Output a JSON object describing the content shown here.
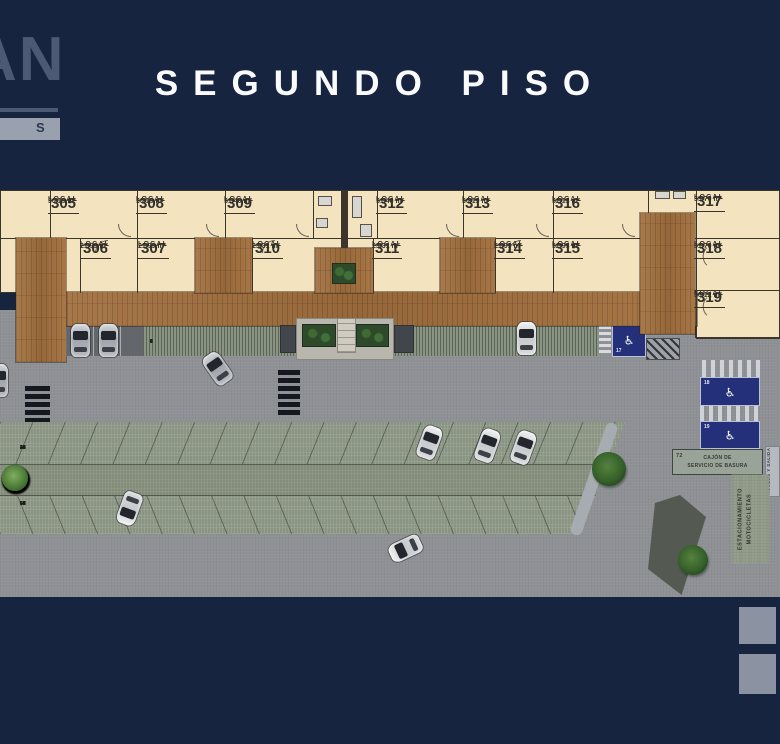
{
  "header": {
    "title": "SEGUNDO PISO",
    "logo_fragment_top": "AN",
    "logo_fragment_bottom": "S"
  },
  "floor": {
    "units": [
      {
        "label": "LOCAL",
        "number": "305",
        "area": "30.19 m²"
      },
      {
        "label": "LOCAL",
        "number": "306",
        "area": "21.99 m²"
      },
      {
        "label": "LOCAL",
        "number": "307",
        "area": "21.99 m²"
      },
      {
        "label": "LOCAL",
        "number": "308",
        "area": "30.19 m²"
      },
      {
        "label": "LOCAL",
        "number": "309",
        "area": "31.40 m²"
      },
      {
        "label": "LOCAL",
        "number": "310",
        "area": "23.31 m²"
      },
      {
        "label": "LOCAL",
        "number": "311",
        "area": "23.31 m²"
      },
      {
        "label": "LOCAL",
        "number": "312",
        "area": "31.40 m²"
      },
      {
        "label": "LOCAL",
        "number": "313",
        "area": "30.19 m²"
      },
      {
        "label": "LOCAL",
        "number": "314",
        "area": "21.99 m²"
      },
      {
        "label": "LOCAL",
        "number": "315",
        "area": "32.93 m²"
      },
      {
        "label": "LOCAL",
        "number": "316",
        "area": "32.13 m²"
      },
      {
        "label": "LOCAL",
        "number": "317",
        "area": "33.70 m²"
      },
      {
        "label": "LOCAL",
        "number": "318",
        "area": "31.70 m²"
      },
      {
        "label": "LOCAL",
        "number": "319",
        "area": "36.12 m²"
      }
    ]
  },
  "parking": {
    "strip_left_numbers": [
      "3",
      "4",
      "5",
      "6",
      "7",
      "8",
      "9"
    ],
    "strip_right_numbers": [
      "10",
      "11",
      "12",
      "13",
      "14",
      "15",
      "16"
    ],
    "island_top_numbers": [
      "28",
      "29",
      "30",
      "31",
      "32",
      "33",
      "34",
      "35",
      "36",
      "37",
      "38",
      "39",
      "40",
      "41",
      "42",
      "43",
      "44",
      "45"
    ],
    "island_bottom_numbers": [
      "54",
      "55",
      "56",
      "57",
      "58",
      "59",
      "60",
      "61",
      "62",
      "63",
      "64",
      "65",
      "66",
      "67",
      "68",
      "69",
      "70",
      "71"
    ],
    "handicap_stalls": [
      {
        "number": "17"
      },
      {
        "number": "18"
      },
      {
        "number": "19"
      }
    ],
    "service_stall": {
      "number": "72",
      "line1": "CAJÓN DE",
      "line2": "SERVICIO DE BASURA"
    },
    "moto_label_line1": "ESTACIONAMIENTO",
    "moto_label_line2": "MOTOCICLETAS",
    "side_label": "ACCESO Y SALIDA"
  },
  "icons": {
    "wheelchair": "♿"
  },
  "colors": {
    "background_navy": "#172440",
    "unit_tan": "#f3e3bf",
    "deck_wood": "#a3703e",
    "paver_green": "#8a9482",
    "asphalt": "#8e9195",
    "handicap_blue": "#25307a",
    "title_white": "#fafbfc"
  }
}
